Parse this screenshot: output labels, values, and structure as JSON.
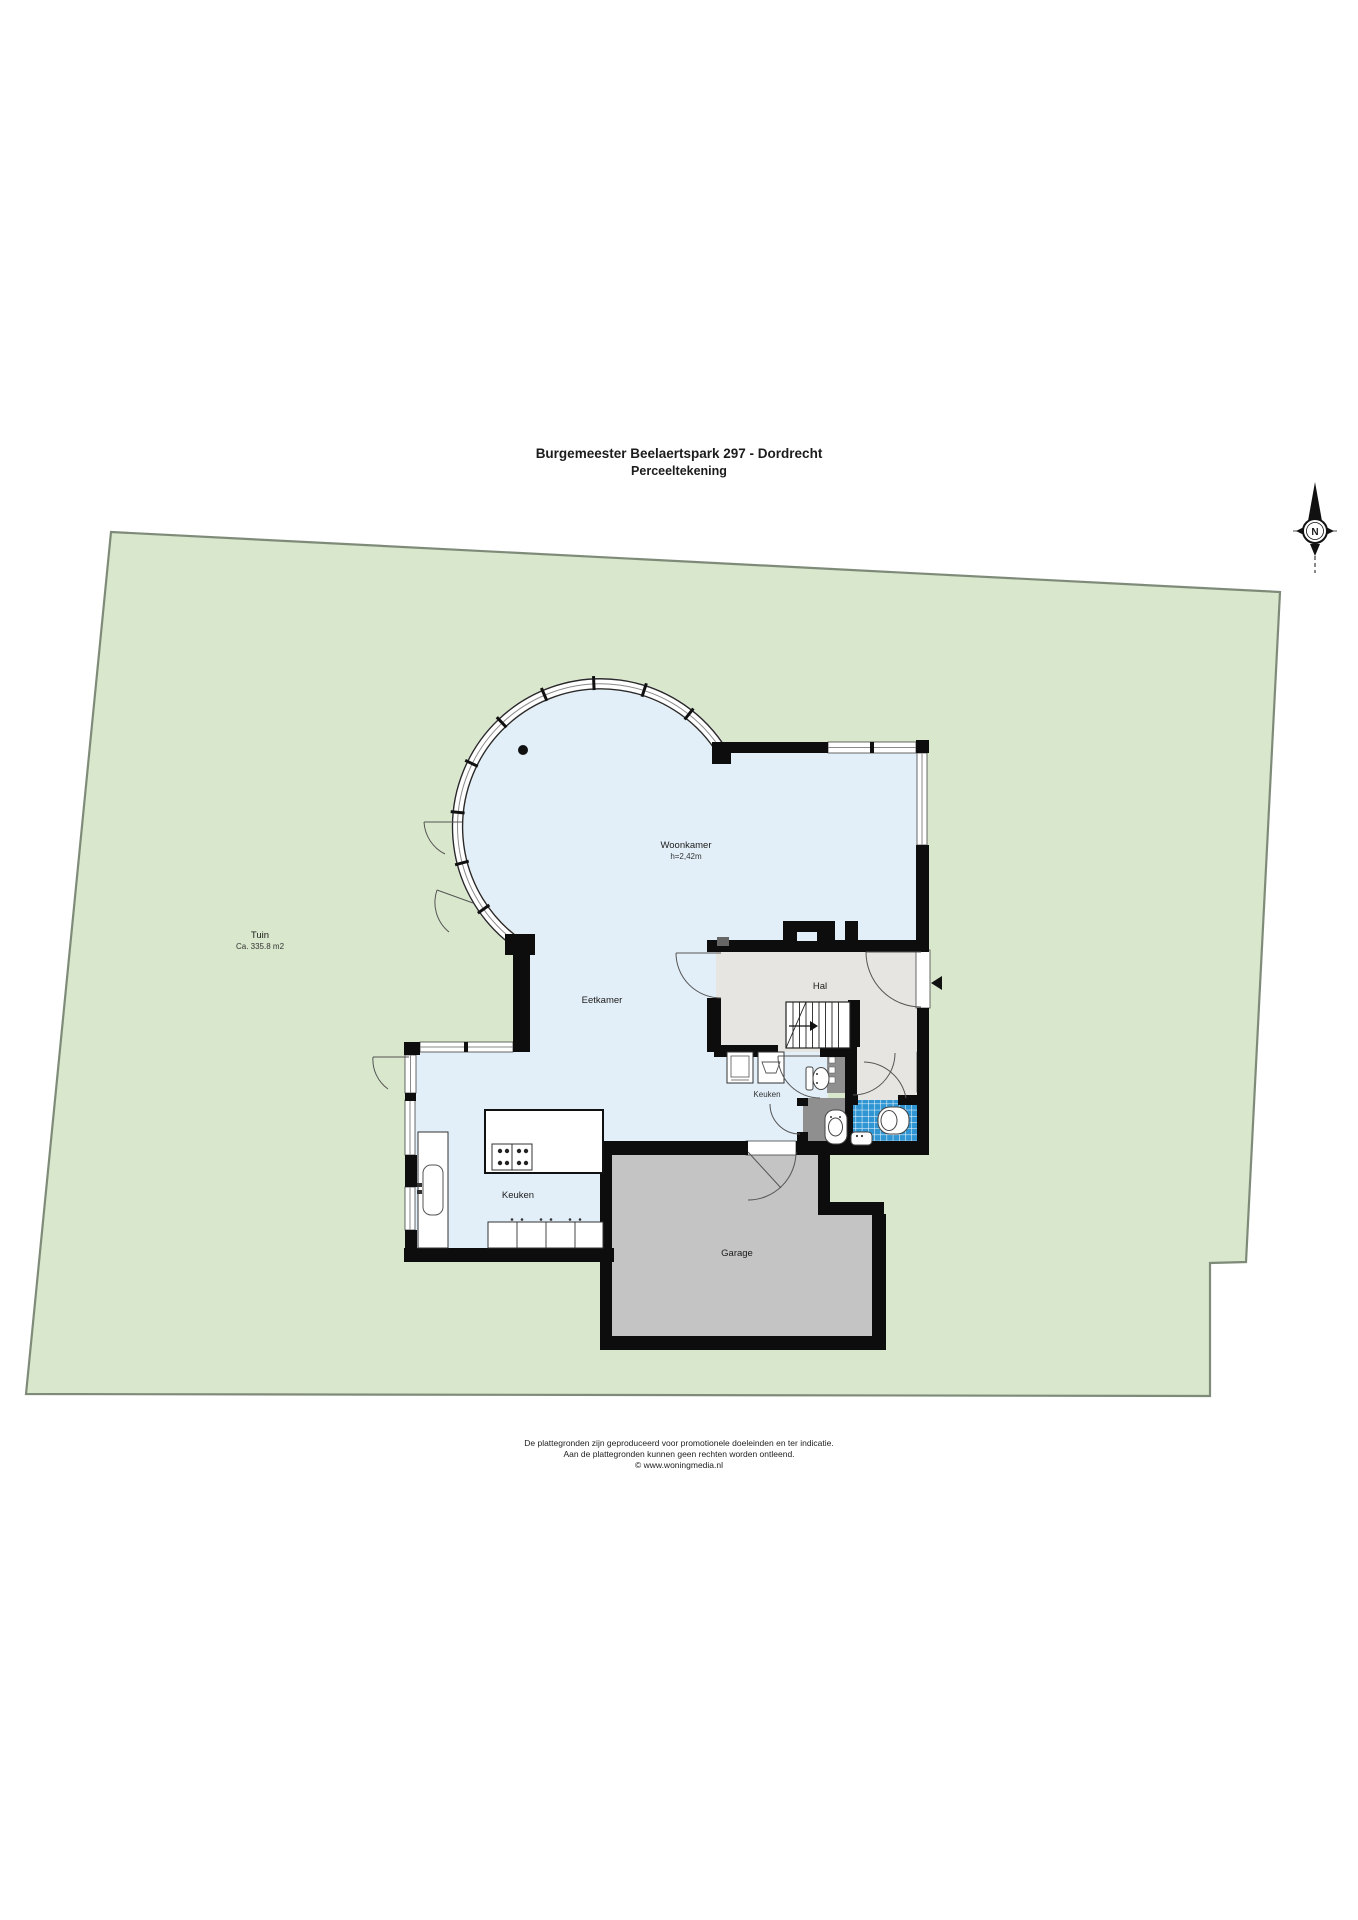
{
  "title": {
    "line1": "Burgemeester Beelaertspark 297 - Dordrecht",
    "line2": "Perceeltekening"
  },
  "compass": {
    "north": "N"
  },
  "garden": {
    "name": "Tuin",
    "area": "Ca. 335.8 m2"
  },
  "rooms": {
    "woonkamer": {
      "name": "Woonkamer",
      "ceiling_height": "h=2,42m"
    },
    "eetkamer": {
      "name": "Eetkamer"
    },
    "hal": {
      "name": "Hal"
    },
    "bijkeuken": {
      "name": "Keuken"
    },
    "keuken": {
      "name": "Keuken"
    },
    "garage": {
      "name": "Garage"
    }
  },
  "footer": {
    "line1": "De plattegronden zijn geproduceerd voor promotionele doeleinden en ter indicatie.",
    "line2": "Aan de plattegronden kunnen geen rechten worden ontleend.",
    "line3": "© www.woningmedia.nl"
  },
  "colors": {
    "garden": "#d9e7cc",
    "garden_border": "#7f8b79",
    "floor": "#e2eff8",
    "hal_floor": "#e6e5e2",
    "garage_floor": "#c4c4c4",
    "duct": "#8f8f8f",
    "tile_blue": "#2f96d3",
    "wall": "#0d0d0d"
  }
}
